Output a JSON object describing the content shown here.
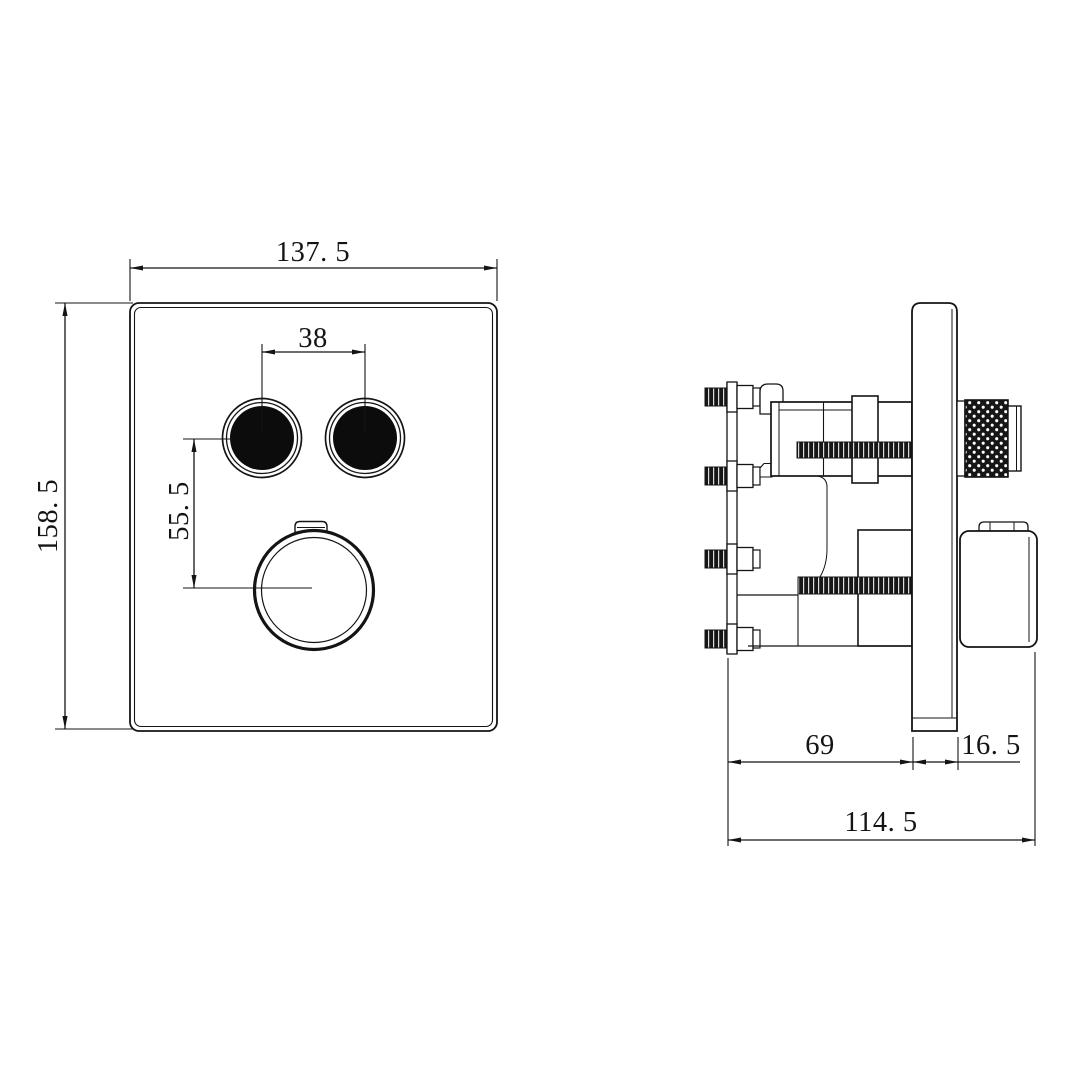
{
  "drawing": {
    "background": "#ffffff",
    "line_color": "#141414",
    "front_view": {
      "dim_width": "137. 5",
      "dim_height": "158. 5",
      "dim_button_spacing": "38",
      "dim_button_to_dial": "55. 5"
    },
    "side_view": {
      "dim_wall_depth": "69",
      "dim_trim_depth": "16. 5",
      "dim_total_depth": "114. 5"
    }
  }
}
